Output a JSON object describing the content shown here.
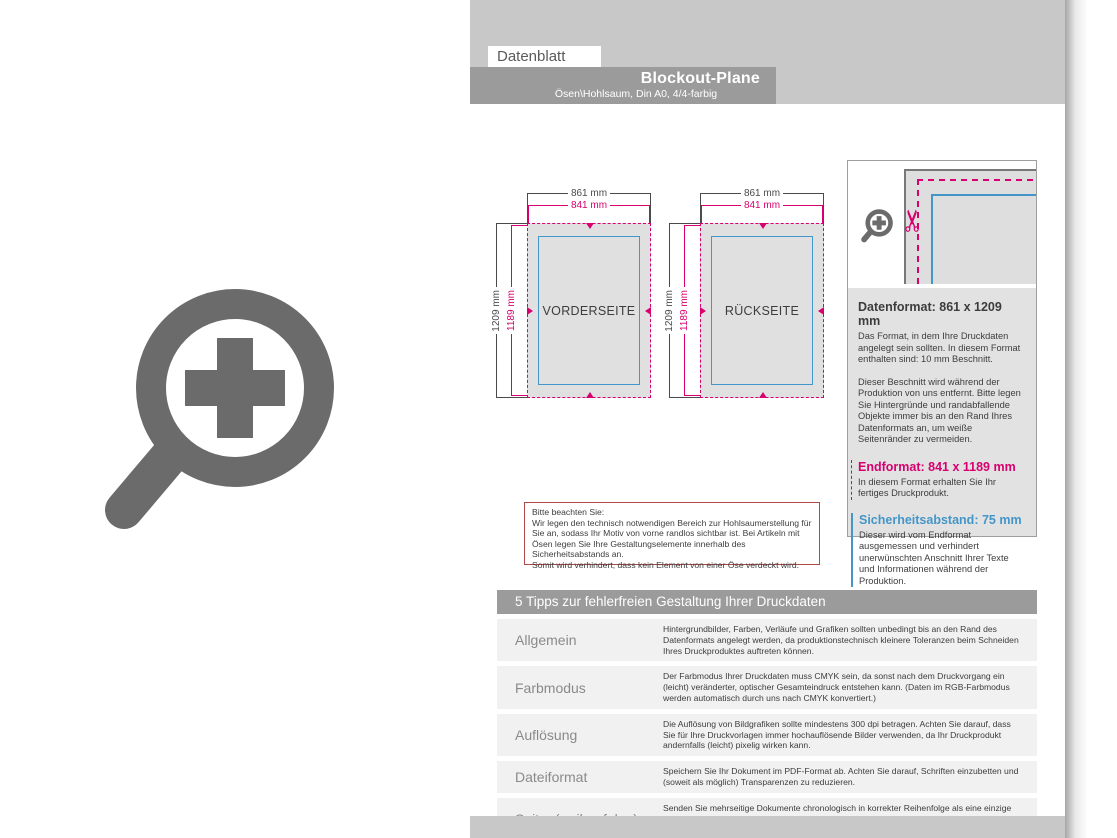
{
  "header": {
    "tab": "Datenblatt",
    "banner_title": "Blockout-Plane",
    "banner_subtitle": "Ösen\\Hohlsaum, Din A0, 4/4-farbig"
  },
  "diagrams": {
    "front": {
      "label": "VORDERSEITE",
      "width_outer": "861 mm",
      "width_inner": "841 mm",
      "height_outer": "1209 mm",
      "height_inner": "1189 mm"
    },
    "back": {
      "label": "RÜCKSEITE",
      "width_outer": "861 mm",
      "width_inner": "841 mm",
      "height_outer": "1209 mm",
      "height_inner": "1189 mm"
    }
  },
  "info_panel": {
    "datenformat_heading": "Datenformat: 861 x 1209 mm",
    "datenformat_body1": "Das Format, in dem Ihre Druckdaten angelegt sein sollten. In diesem Format enthalten sind: 10 mm Beschnitt.",
    "datenformat_body2": "Dieser Beschnitt wird während der Produktion von uns entfernt. Bitte legen Sie Hintergründe und randabfallende Objekte immer bis an den Rand Ihres Datenformats an, um weiße Seitenränder zu vermeiden.",
    "endformat_heading": "Endformat: 841 x 1189 mm",
    "endformat_body": "In diesem Format erhalten Sie Ihr fertiges Druckprodukt.",
    "sicherheitsabstand_heading": "Sicherheitsabstand: 75 mm",
    "sicherheitsabstand_body": "Dieser wird vom Endformat ausgemessen und verhindert unerwünschten Anschnitt Ihrer Texte und Informationen während der Produktion."
  },
  "notice": "Bitte beachten Sie:\nWir legen den technisch notwendigen Bereich zur Hohlsaumerstellung für Sie an, sodass Ihr Motiv von vorne randlos sichtbar ist. Bei Artikeln mit Ösen legen Sie Ihre Gestaltungselemente innerhalb des Sicherheitsabstands an.\nSomit wird verhindert, dass kein Element von einer Öse verdeckt wird.",
  "tips": {
    "heading": "5 Tipps zur fehlerfreien Gestaltung Ihrer Druckdaten",
    "rows": [
      {
        "label": "Allgemein",
        "text": "Hintergrundbilder, Farben, Verläufe und Grafiken sollten unbedingt bis an den Rand des Datenformats angelegt werden, da produktionstechnisch kleinere Toleranzen beim Schneiden Ihres Druckproduktes auftreten können."
      },
      {
        "label": "Farbmodus",
        "text": "Der Farbmodus Ihrer Druckdaten muss CMYK sein, da sonst nach dem Druckvorgang ein (leicht) veränderter, optischer Gesamteindruck entstehen kann. (Daten im RGB-Farbmodus werden automatisch durch uns nach CMYK konvertiert.)"
      },
      {
        "label": "Auflösung",
        "text": "Die Auflösung von Bildgrafiken sollte mindestens 300 dpi betragen. Achten Sie darauf, dass Sie für Ihre Druckvorlagen immer hochauflösende Bilder verwenden, da Ihr Druckprodukt andernfalls (leicht) pixelig wirken kann."
      },
      {
        "label": "Dateiformat",
        "text": "Speichern Sie Ihr Dokument im PDF-Format ab. Achten Sie darauf, Schriften einzubetten und (soweit als möglich) Transparenzen zu reduzieren."
      },
      {
        "label": "Seiten(-reihenfolge)",
        "text": "Senden Sie mehrseitige Dokumente chronologisch in korrekter Reihenfolge als eine einzige PDF-Datei oder benennen Sie Einzeldokumente entsprechend mit fortlaufenden Seitennummern."
      }
    ]
  },
  "icons": {
    "zoom_large": "zoom-in-icon",
    "zoom_small": "zoom-in-icon",
    "scissors": "scissors-icon"
  },
  "colors": {
    "magenta": "#d8006f",
    "blue": "#4596c8",
    "banner_gray": "#9b9b9b",
    "band_gray": "#c8c8c8",
    "notice_border": "#b04a4a",
    "icon_gray": "#6b6b6b"
  }
}
